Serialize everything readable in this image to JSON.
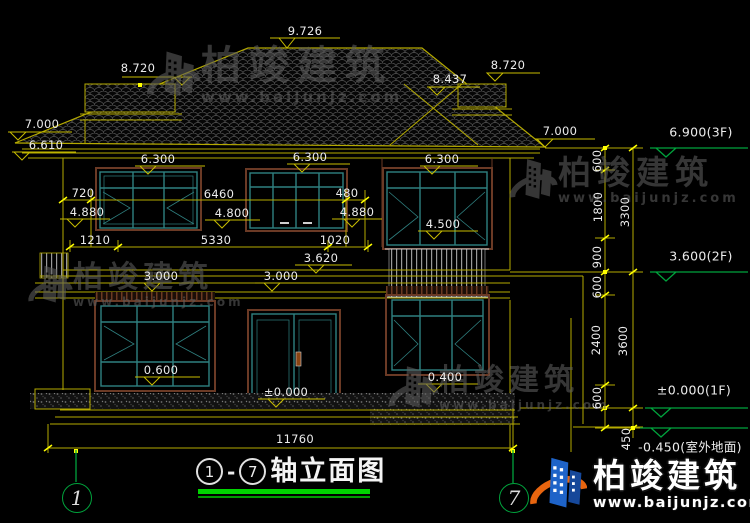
{
  "watermark": {
    "name": "柏竣建筑",
    "url": "www.baijunjz.com"
  },
  "brand": {
    "name": "柏竣建筑",
    "url": "www.baijunjz.com"
  },
  "title": {
    "axis_start": "1",
    "separator": "-",
    "axis_end": "7",
    "text": "轴立面图"
  },
  "axis_bubbles": {
    "left": "1",
    "right": "7"
  },
  "annotations": {
    "dims": [
      {
        "t": "9.726",
        "x": 305,
        "y": 31
      },
      {
        "t": "8.720",
        "x": 138,
        "y": 68
      },
      {
        "t": "8.437",
        "x": 450,
        "y": 79
      },
      {
        "t": "8.720",
        "x": 508,
        "y": 65
      },
      {
        "t": "7.000",
        "x": 42,
        "y": 124
      },
      {
        "t": "6.610",
        "x": 46,
        "y": 145
      },
      {
        "t": "7.000",
        "x": 560,
        "y": 131
      },
      {
        "t": "6.300",
        "x": 158,
        "y": 159
      },
      {
        "t": "6.300",
        "x": 310,
        "y": 157
      },
      {
        "t": "6.300",
        "x": 442,
        "y": 159
      },
      {
        "t": "720",
        "x": 83,
        "y": 193
      },
      {
        "t": "6460",
        "x": 219,
        "y": 194
      },
      {
        "t": "480",
        "x": 347,
        "y": 193
      },
      {
        "t": "4.880",
        "x": 87,
        "y": 212
      },
      {
        "t": "4.800",
        "x": 232,
        "y": 213
      },
      {
        "t": "4.880",
        "x": 357,
        "y": 212
      },
      {
        "t": "4.500",
        "x": 443,
        "y": 224
      },
      {
        "t": "1210",
        "x": 95,
        "y": 240
      },
      {
        "t": "5330",
        "x": 216,
        "y": 240
      },
      {
        "t": "1020",
        "x": 335,
        "y": 240
      },
      {
        "t": "3.620",
        "x": 321,
        "y": 258
      },
      {
        "t": "3.000",
        "x": 161,
        "y": 276
      },
      {
        "t": "3.000",
        "x": 281,
        "y": 276
      },
      {
        "t": "0.600",
        "x": 161,
        "y": 370
      },
      {
        "t": "±0.000",
        "x": 286,
        "y": 392
      },
      {
        "t": "0.400",
        "x": 445,
        "y": 377
      },
      {
        "t": "11760",
        "x": 295,
        "y": 439
      }
    ],
    "dims_rotated": [
      {
        "t": "600",
        "x": 597,
        "y": 161
      },
      {
        "t": "1800",
        "x": 598,
        "y": 207
      },
      {
        "t": "3300",
        "x": 625,
        "y": 212
      },
      {
        "t": "900",
        "x": 597,
        "y": 257
      },
      {
        "t": "600",
        "x": 597,
        "y": 287
      },
      {
        "t": "2400",
        "x": 596,
        "y": 340
      },
      {
        "t": "3600",
        "x": 623,
        "y": 341
      },
      {
        "t": "600",
        "x": 597,
        "y": 398
      },
      {
        "t": "450",
        "x": 626,
        "y": 439
      }
    ],
    "levels_right": [
      {
        "t": "6.900(3F)",
        "x": 701,
        "y": 132
      },
      {
        "t": "3.600(2F)",
        "x": 701,
        "y": 256
      },
      {
        "t": "±0.000(1F)",
        "x": 694,
        "y": 390
      },
      {
        "t": "-0.450(室外地面)",
        "x": 690,
        "y": 446
      }
    ]
  },
  "colors": {
    "background": "#000000",
    "line_yellow": "#b5aa00",
    "bright_yellow": "#ffff00",
    "marker_green": "#00a23c",
    "window_teal": "#2f8080",
    "trim_brown": "#6b3a25",
    "dim_text": "#ececec",
    "title_underline": "#00d400",
    "brand_blue": "#1e63c8",
    "brand_orange": "#e8650f",
    "watermark_gray": "#5d5d5d"
  }
}
